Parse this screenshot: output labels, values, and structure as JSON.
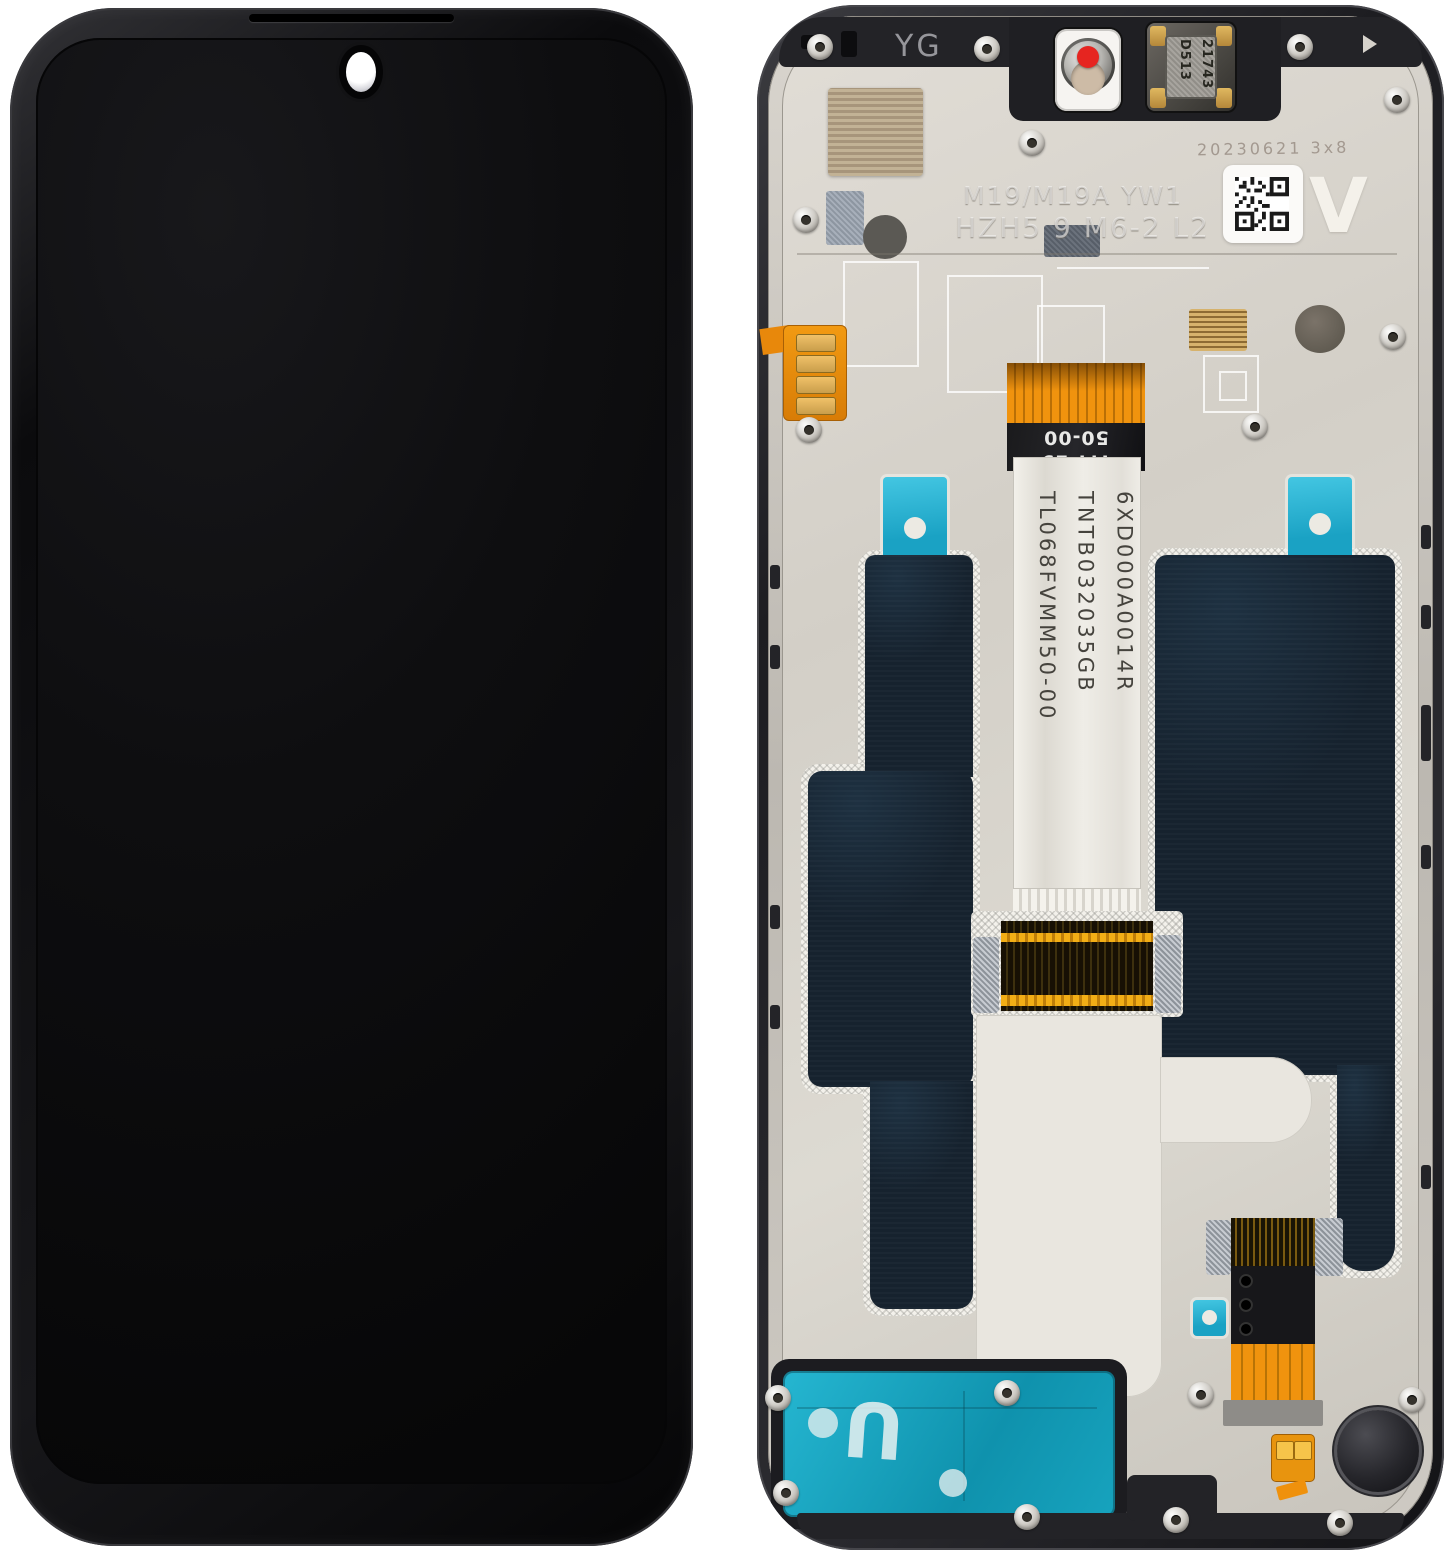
{
  "product": {
    "front_panel": {
      "description_labels": {}
    },
    "back_panel": {
      "top": {
        "yg_marking": "YG"
      },
      "earpiece_speaker": {
        "code_line1": "D513",
        "code_line2": "21743"
      },
      "frame_etch": {
        "line1": "M19/M19A YW1",
        "line2": "HZH5 9 M6-2 L2"
      },
      "qr_area": {
        "date_stamp": "20230621 3x8",
        "version_marking": "V"
      },
      "main_flex": {
        "band_code_line1": "TM-19",
        "band_code_line2": "50-00",
        "label_line1": "TL068FVMM50-00",
        "label_line2": "TNTB032035GB",
        "label_line3": "6XD000A0014R"
      },
      "speaker_adhesive": {
        "marking": "U"
      },
      "colors": {
        "graphite_sheet": "#16222e",
        "adhesive_tab_cyan": "#29b7d8",
        "speaker_adhesive_teal": "#14a6c0",
        "flex_orange": "#ef910c",
        "gold_contact": "#d9a545",
        "plate_silver": "#d7d3cb",
        "camera_dot_red": "#e62520",
        "frame_black": "#1c1c1f"
      }
    }
  }
}
